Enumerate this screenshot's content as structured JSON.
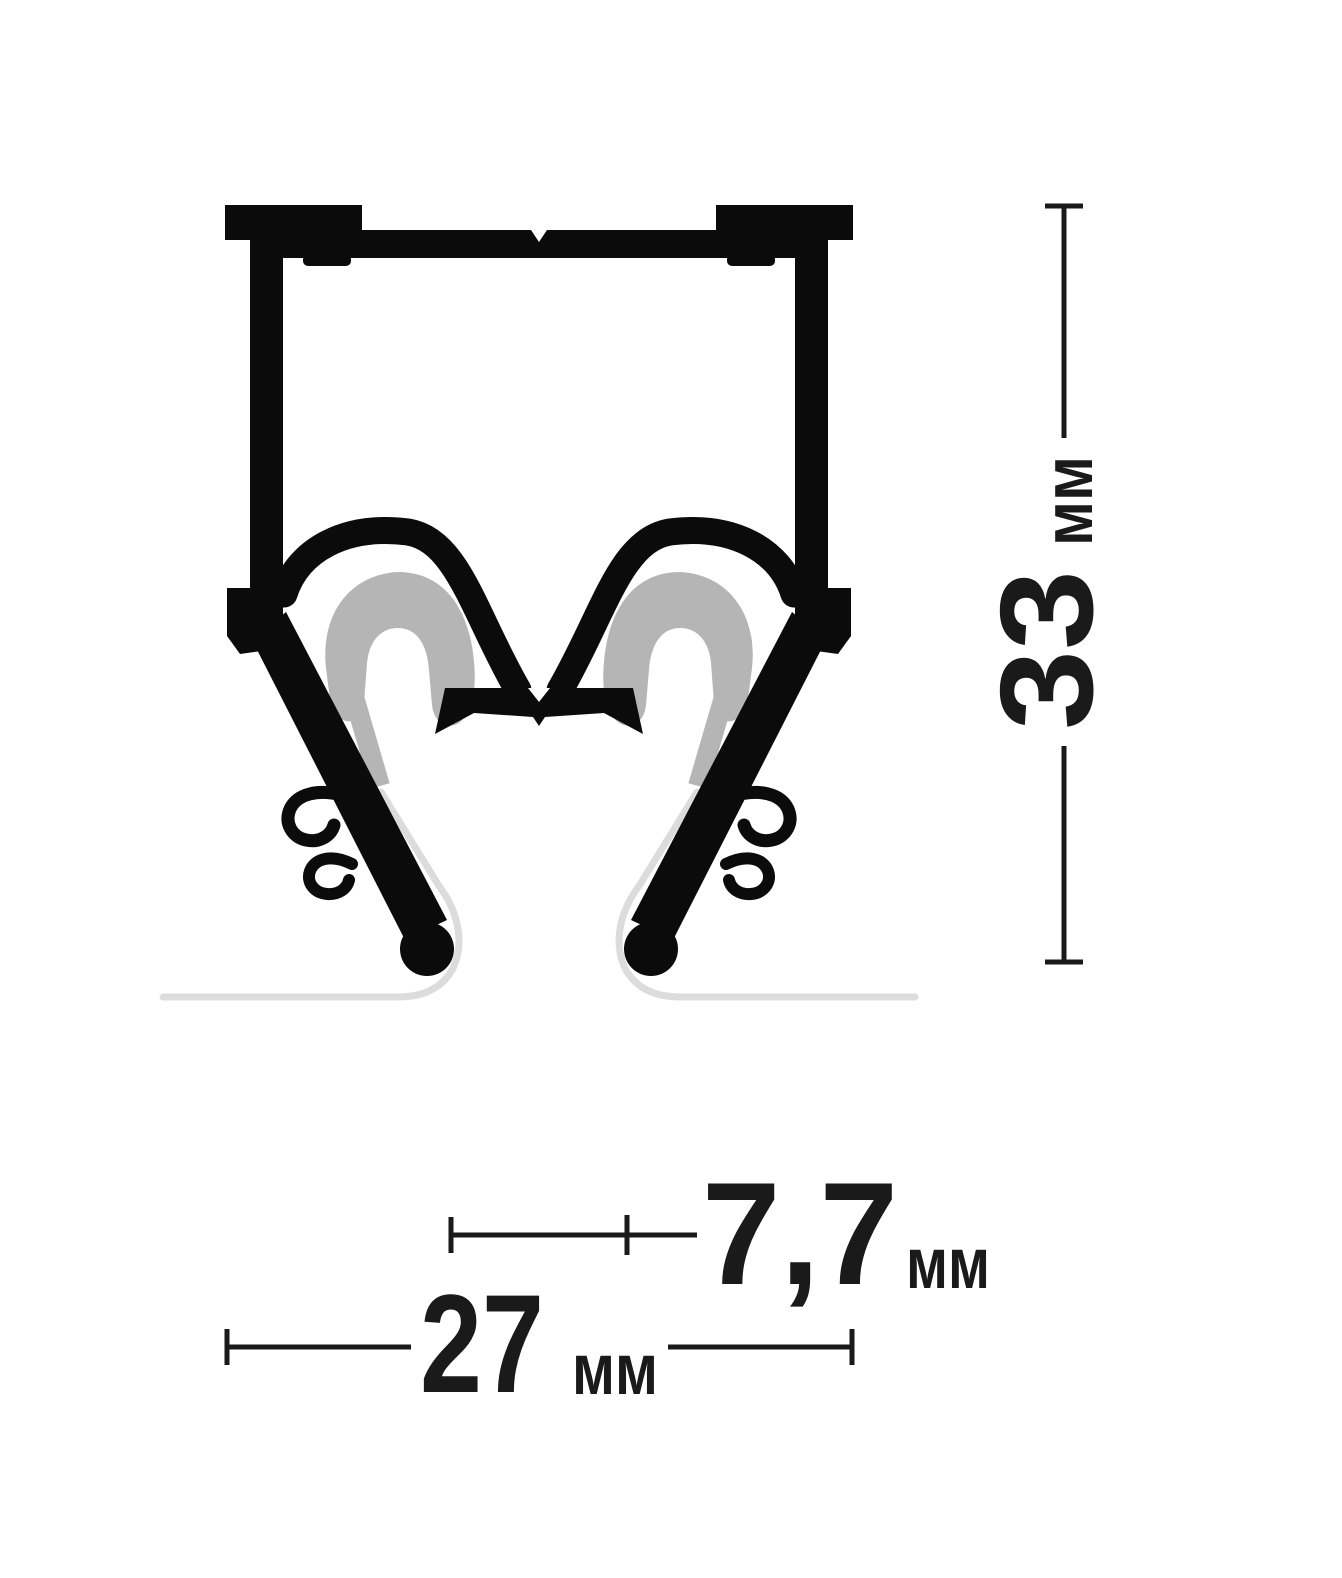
{
  "drawing": {
    "kind": "profile-cross-section",
    "dimensions": {
      "height": {
        "value": "33",
        "unit": "мм"
      },
      "gap": {
        "value": "7,7",
        "unit": "мм"
      },
      "width": {
        "value": "27",
        "unit": "мм"
      }
    },
    "colors": {
      "background": "#ffffff",
      "profile_ink": "#0b0b0b",
      "clip_gray": "#b5b5b5",
      "membrane_gray": "#dcdcdc",
      "dimension_ink": "#1a1a1a"
    }
  }
}
